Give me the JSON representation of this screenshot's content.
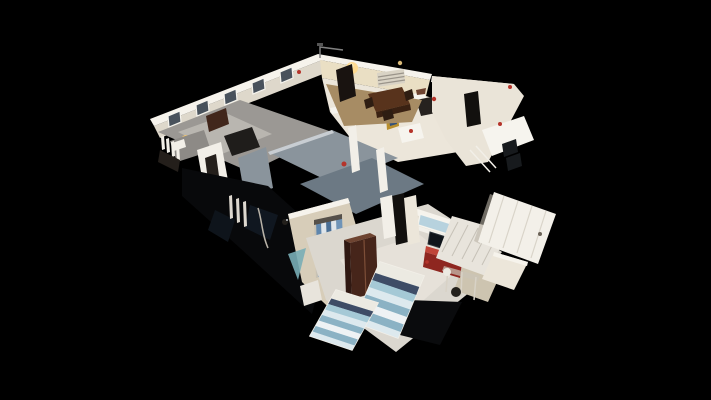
{
  "scene": {
    "type": "3d-dollhouse-cutaway-view",
    "description": "Isometric cutaway dollhouse scan of a single-story home rendered on a black void background",
    "canvas_width": 711,
    "canvas_height": 400,
    "regions": [
      "sitting-room",
      "dining-room",
      "kitchen",
      "bathroom-wing",
      "roof-cutaway",
      "stairwell",
      "closet-room",
      "twin-bedroom",
      "door-hallway"
    ]
  },
  "palette": {
    "bg": "#000000",
    "wallTop": "#f6f3ec",
    "wallFace": "#ded8cb",
    "wallWarm": "#eadfc4",
    "wallKitchen": "#ece6da",
    "wallRight": "#eae4d8",
    "wallBedroom": "#e0d9ca",
    "wallCream": "#d7cdb9",
    "wallCreamDark": "#cdc4b0",
    "floorDim": "#9b9894",
    "carpet": "#b9b6b0",
    "floorDining": "#a78c64",
    "floorBedroom": "#dbd7cf",
    "floorBedroomLight": "#e7e3da",
    "floorHall": "#e8e4dc",
    "roofA": "#8a949c",
    "roofB": "#6c7984",
    "roofEdge": "#c8cdd2",
    "shadow": "#08090b",
    "shadowBlue": "#131c26",
    "shadowBlue2": "#0e141b",
    "cutDark": "#0a0b0d",
    "woodDark": "#41261b",
    "woodDining": "#58331c",
    "woodDiningSide": "#3a2112",
    "chairWood": "#2e1d12",
    "sofaDark": "#1f1d1b",
    "bedGray": "#8d8a86",
    "white": "#f2efe8",
    "whiteBright": "#f6f4ee",
    "blockInner": "#241f1b",
    "counterDark": "#26221f",
    "doorwayDark": "#12100e",
    "doorwayDark2": "#191310",
    "tvDark": "#0f141a",
    "darkSquare": "#171a1d",
    "windowDark": "#49525c",
    "windowBlue": "#b7d2de",
    "sillWhite": "#f2f0ea",
    "lampGlow": "#f7c96b",
    "lampCore": "#fff3c4",
    "lampWarm": "#ffd98d",
    "red": "#b5342b",
    "redCabinetTop": "#c04438",
    "redCabinetFront": "#8e2620",
    "wardrobeTop": "#6e4431",
    "wardrobeFront": "#46251a",
    "wardrobeSide": "#2f1812",
    "wardrobeHi": "#7d4e38",
    "clothesA": "#5f86ad",
    "clothesB": "#dfe5ea",
    "clothesC": "#4a6f96",
    "clothesD": "#6f94b8",
    "closetBar": "#55504a",
    "closetBack": "#c8c2b4",
    "teal": "#79aeb6",
    "doorWhite": "#f3f0e9",
    "doorPanel": "#d9d4c9",
    "doorShadow": "#b9b2a5",
    "handle": "#6b6257",
    "railWhite": "#ddd8cf",
    "handrail": "#b9b3a8",
    "frameLight": "#cbc5b8",
    "deskLeg": "#d8d2c6",
    "chairDark": "#23201c",
    "pictureGold": "#b98f2e",
    "pictureBlue": "#30507a",
    "ventFace": "#d9d3c5",
    "ventSlat": "#9a948a",
    "antenna": "#808080",
    "stripeLight": "#dde9ee",
    "stripeMid": "#a5c9d6",
    "stripeDeep": "#8bb2c4",
    "stripeWhite": "#eef2f4",
    "bedPillow": "#eceae2",
    "bedNavy": "#3e4c66"
  }
}
